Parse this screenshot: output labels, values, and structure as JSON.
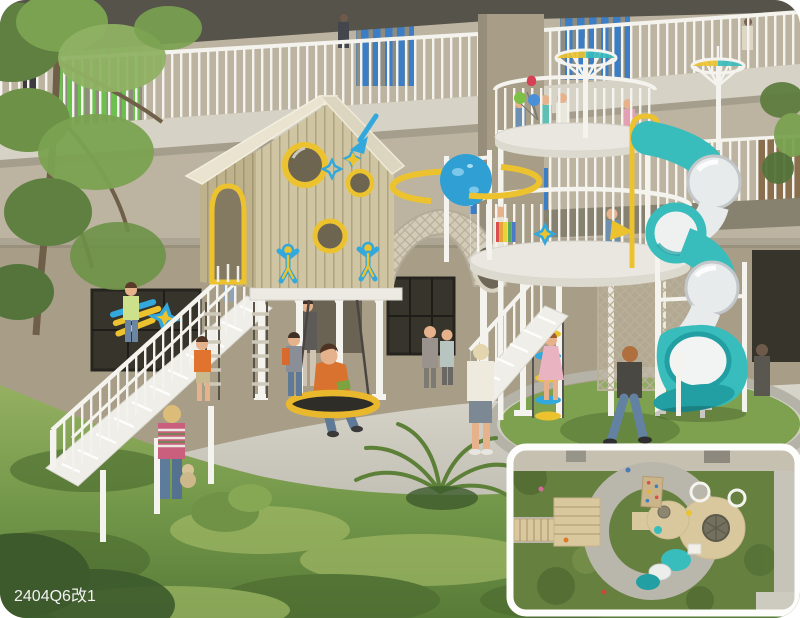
{
  "scene": {
    "title": "Courtyard children's playground rendering",
    "watermark": "2404Q6改1"
  },
  "colors": {
    "soffit": "#56534a",
    "wall_upper": "#bcb4a1",
    "wall_lower": "#a89e88",
    "slab": "#d6d2c5",
    "slab_shadow": "#87816f",
    "railing_white": "#f4f3ee",
    "slats_green": "#6cc14e",
    "slats_blue": "#3b7ec6",
    "window_dark": "#37342b",
    "wood_wall": "#8a6f4e",
    "house_wood": "#cfc5a3",
    "house_wood_dark": "#beb28c",
    "roof_light": "#e9e3d0",
    "roof_dark": "#dcd5c0",
    "accent_yellow": "#ecc32f",
    "accent_blue": "#32a8dc",
    "slide_teal": "#38bcbc",
    "slide_teal_dark": "#219fa2",
    "tube_clear": "#e8ebec",
    "mesh_tan": "#d3cbb8",
    "pavement": "#ccc9bf",
    "grass_light": "#a9c06b",
    "grass_mid": "#7da14f",
    "grass_dark": "#4a692f",
    "bush_dark": "#3c5a2c",
    "skin": "#e6b28c",
    "swing_yellow": "#e9b82d",
    "plan_grass": "#66803f",
    "plan_pavement": "#b9b6ac",
    "plan_deck": "#d9c79d"
  },
  "decals": {
    "planet": "saturn-planet-decal",
    "shooting_star": "shooting-star-decal",
    "rocket_arrow": "rocket-arrow-decal",
    "kid_silhouette": "kid-silhouette-decal",
    "star_badge": "star-badge-decal",
    "pennant": "yellow-pennant-decal",
    "balloons": "heart-and-round-balloons"
  },
  "equipment": [
    "playhouse-on-stilts",
    "white-staircase",
    "rope-tunnel-arch",
    "round-play-tower",
    "spiral-tube-slide",
    "nest-swing",
    "rope-ladder",
    "disc-rope-climber",
    "mesh-climb-panel",
    "canopy-umbrella"
  ]
}
